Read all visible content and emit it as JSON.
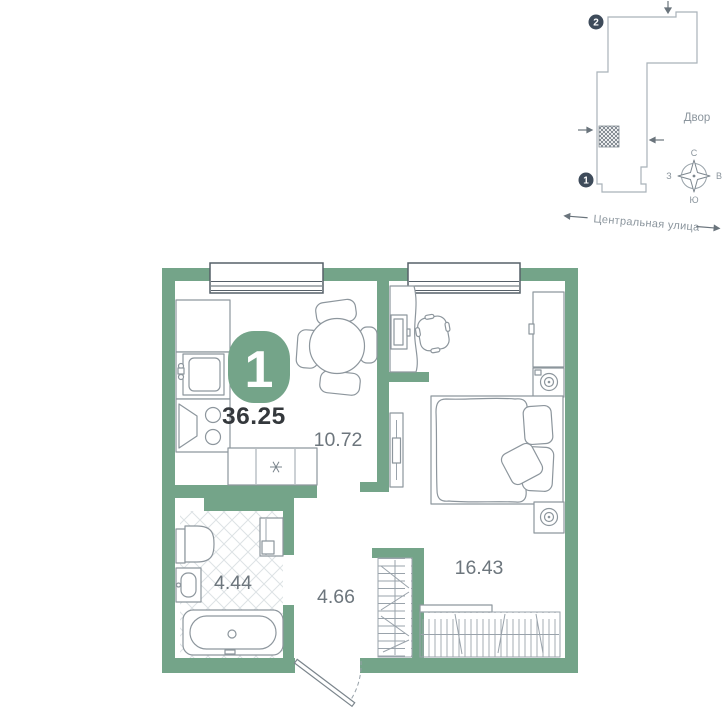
{
  "floor_plan": {
    "badge": {
      "rooms": "1",
      "area": "36.25"
    },
    "rooms": [
      {
        "name": "kitchen-living",
        "area": "10.72"
      },
      {
        "name": "bedroom",
        "area": "16.43"
      },
      {
        "name": "bathroom",
        "area": "4.44"
      },
      {
        "name": "hallway",
        "area": "4.66"
      }
    ],
    "colors": {
      "wall": "#74a489",
      "furniture": "#8d969d",
      "room_label": "#6d767d",
      "area_text": "#34383c"
    }
  },
  "site_plan": {
    "courtyard": "Двор",
    "street": "Центральная улица",
    "markers": {
      "one": "1",
      "two": "2"
    },
    "compass": {
      "north": "С",
      "east": "В",
      "south": "Ю",
      "west": "З"
    },
    "colors": {
      "outline": "#a9b2b9",
      "marker_bg": "#3e4b5a",
      "label": "#8b959d"
    }
  }
}
